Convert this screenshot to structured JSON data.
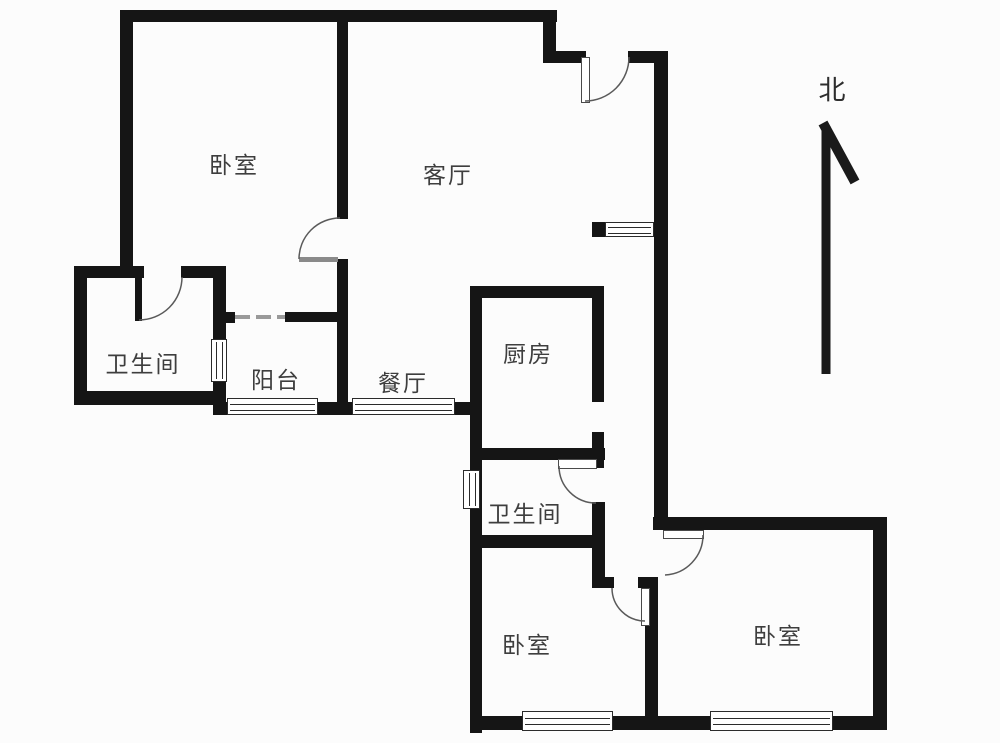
{
  "compass": {
    "label": "北"
  },
  "rooms": [
    {
      "id": "bedroom-top-left",
      "label": "卧室"
    },
    {
      "id": "living-room",
      "label": "客厅"
    },
    {
      "id": "bathroom-left",
      "label": "卫生间"
    },
    {
      "id": "balcony",
      "label": "阳台"
    },
    {
      "id": "dining-room",
      "label": "餐厅"
    },
    {
      "id": "kitchen",
      "label": "厨房"
    },
    {
      "id": "bathroom-middle",
      "label": "卫生间"
    },
    {
      "id": "bedroom-bottom-middle",
      "label": "卧室"
    },
    {
      "id": "bedroom-bottom-right",
      "label": "卧室"
    }
  ],
  "colors": {
    "wall": "#151515",
    "label_text": "#3e3e3e",
    "door_arc": "#5a5a5a",
    "background": "#fcfcfc"
  }
}
